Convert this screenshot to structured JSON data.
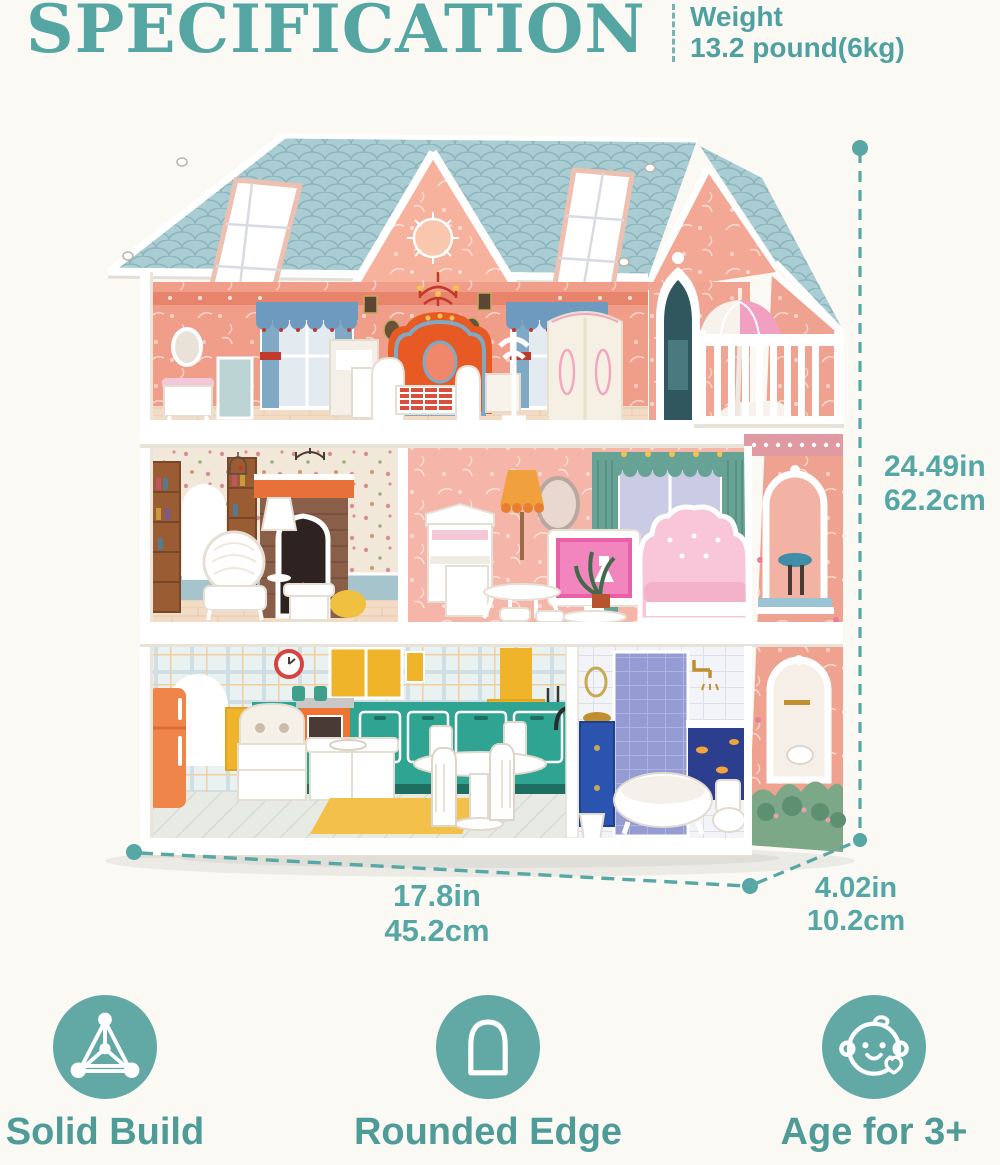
{
  "header": {
    "title": "SPECIFICATION",
    "weight_label": "Weight",
    "weight_value": "13.2 pound(6kg)"
  },
  "dimensions": {
    "height": {
      "inches": "24.49in",
      "cm": "62.2cm"
    },
    "width": {
      "inches": "17.8in",
      "cm": "45.2cm"
    },
    "depth": {
      "inches": "4.02in",
      "cm": "10.2cm"
    }
  },
  "features": [
    {
      "icon": "tetrahedron-icon",
      "label": "Solid Build"
    },
    {
      "icon": "arch-icon",
      "label": "Rounded Edge"
    },
    {
      "icon": "baby-face-icon",
      "label": "Age for 3+"
    }
  ],
  "colors": {
    "accent_teal": "#55a6a4",
    "icon_circle": "#62a9a5",
    "roof_blue": "#a9cdd3",
    "wall_salmon": "#efa28f",
    "wallpaper_pink": "#f09e8a"
  }
}
